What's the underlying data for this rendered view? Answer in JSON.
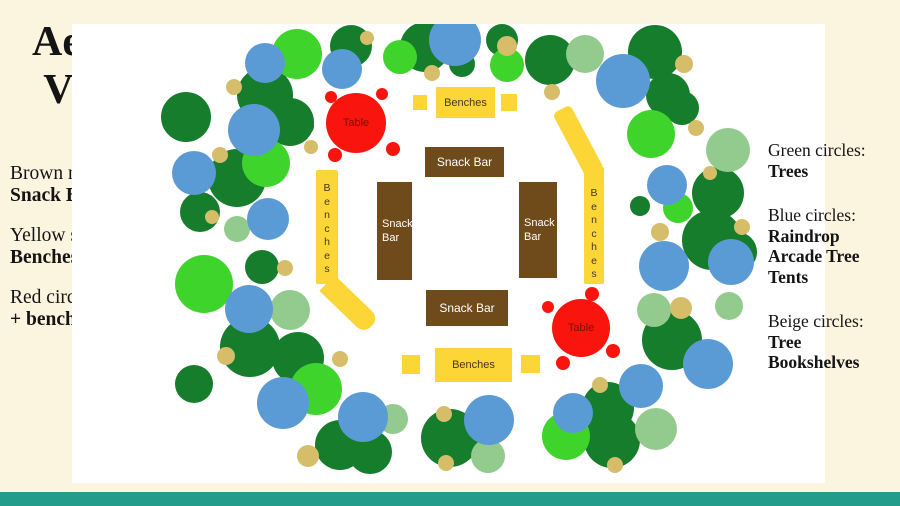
{
  "page": {
    "background": "#FBF4DF",
    "footer_color": "#249C8C"
  },
  "title": {
    "line1": "Aerial",
    "line2": "View"
  },
  "key": {
    "heading": "Key",
    "items": [
      {
        "normal": "Brown rectangles:",
        "bold": "Snack Bars"
      },
      {
        "normal": "Yellow shapes:",
        "bold": "Benches"
      },
      {
        "normal": "Red circle: ",
        "bold": "Tables + benches"
      }
    ]
  },
  "legend_right": {
    "items": [
      {
        "normal": "Green circles:",
        "bold": "Trees"
      },
      {
        "normal": "Blue circles:",
        "bold": "Raindrop Arcade Tree Tents"
      },
      {
        "normal": "Beige circles:",
        "bold": "Tree Bookshelves"
      }
    ]
  },
  "scene": {
    "panel": {
      "x": 72,
      "y": 24,
      "w": 753,
      "h": 459,
      "bg": "#FFFFFF"
    },
    "colors": {
      "dg": "#157D2B",
      "bg": "#3FD42C",
      "sg": "#93CA8E",
      "bl": "#5B9BD5",
      "be": "#D5BD69",
      "yellow": "#FCD637",
      "brown": "#6F4A1A",
      "red": "#F9140E",
      "table_text": "#7C1100",
      "bench_text": "#453916",
      "snack_text": "#FFFFFF"
    },
    "circles": [
      {
        "x": 186,
        "y": 117,
        "r": 25,
        "c": "dg"
      },
      {
        "x": 200,
        "y": 212,
        "r": 20,
        "c": "dg"
      },
      {
        "x": 237,
        "y": 178,
        "r": 29,
        "c": "dg"
      },
      {
        "x": 262,
        "y": 267,
        "r": 17,
        "c": "dg"
      },
      {
        "x": 265,
        "y": 95,
        "r": 28,
        "c": "dg"
      },
      {
        "x": 290,
        "y": 122,
        "r": 24,
        "c": "dg"
      },
      {
        "x": 305,
        "y": 126,
        "r": 9,
        "c": "dg"
      },
      {
        "x": 351,
        "y": 46,
        "r": 21,
        "c": "dg"
      },
      {
        "x": 425,
        "y": 47,
        "r": 25,
        "c": "dg"
      },
      {
        "x": 462,
        "y": 64,
        "r": 13,
        "c": "dg"
      },
      {
        "x": 502,
        "y": 40,
        "r": 16,
        "c": "dg"
      },
      {
        "x": 550,
        "y": 60,
        "r": 25,
        "c": "dg"
      },
      {
        "x": 655,
        "y": 52,
        "r": 27,
        "c": "dg"
      },
      {
        "x": 668,
        "y": 95,
        "r": 22,
        "c": "dg"
      },
      {
        "x": 682,
        "y": 108,
        "r": 17,
        "c": "dg"
      },
      {
        "x": 640,
        "y": 206,
        "r": 10,
        "c": "dg"
      },
      {
        "x": 718,
        "y": 193,
        "r": 26,
        "c": "dg"
      },
      {
        "x": 712,
        "y": 240,
        "r": 30,
        "c": "dg"
      },
      {
        "x": 737,
        "y": 252,
        "r": 20,
        "c": "dg"
      },
      {
        "x": 672,
        "y": 340,
        "r": 30,
        "c": "dg"
      },
      {
        "x": 608,
        "y": 408,
        "r": 26,
        "c": "dg"
      },
      {
        "x": 612,
        "y": 440,
        "r": 28,
        "c": "dg"
      },
      {
        "x": 450,
        "y": 438,
        "r": 29,
        "c": "dg"
      },
      {
        "x": 370,
        "y": 452,
        "r": 22,
        "c": "dg"
      },
      {
        "x": 340,
        "y": 445,
        "r": 25,
        "c": "dg"
      },
      {
        "x": 250,
        "y": 347,
        "r": 30,
        "c": "dg"
      },
      {
        "x": 298,
        "y": 358,
        "r": 26,
        "c": "dg"
      },
      {
        "x": 194,
        "y": 384,
        "r": 19,
        "c": "dg"
      },
      {
        "x": 297,
        "y": 54,
        "r": 25,
        "c": "bg"
      },
      {
        "x": 400,
        "y": 57,
        "r": 17,
        "c": "bg"
      },
      {
        "x": 507,
        "y": 65,
        "r": 17,
        "c": "bg"
      },
      {
        "x": 651,
        "y": 134,
        "r": 24,
        "c": "bg"
      },
      {
        "x": 678,
        "y": 208,
        "r": 15,
        "c": "bg"
      },
      {
        "x": 266,
        "y": 163,
        "r": 24,
        "c": "bg"
      },
      {
        "x": 204,
        "y": 284,
        "r": 29,
        "c": "bg"
      },
      {
        "x": 316,
        "y": 389,
        "r": 26,
        "c": "bg"
      },
      {
        "x": 566,
        "y": 436,
        "r": 24,
        "c": "bg"
      },
      {
        "x": 585,
        "y": 54,
        "r": 19,
        "c": "sg"
      },
      {
        "x": 728,
        "y": 150,
        "r": 22,
        "c": "sg"
      },
      {
        "x": 237,
        "y": 229,
        "r": 13,
        "c": "sg"
      },
      {
        "x": 290,
        "y": 310,
        "r": 20,
        "c": "sg"
      },
      {
        "x": 654,
        "y": 310,
        "r": 17,
        "c": "sg"
      },
      {
        "x": 729,
        "y": 306,
        "r": 14,
        "c": "sg"
      },
      {
        "x": 393,
        "y": 419,
        "r": 15,
        "c": "sg"
      },
      {
        "x": 488,
        "y": 456,
        "r": 17,
        "c": "sg"
      },
      {
        "x": 656,
        "y": 429,
        "r": 21,
        "c": "sg"
      },
      {
        "x": 265,
        "y": 63,
        "r": 20,
        "c": "bl"
      },
      {
        "x": 342,
        "y": 69,
        "r": 20,
        "c": "bl"
      },
      {
        "x": 455,
        "y": 40,
        "r": 26,
        "c": "bl"
      },
      {
        "x": 623,
        "y": 81,
        "r": 27,
        "c": "bl"
      },
      {
        "x": 254,
        "y": 130,
        "r": 26,
        "c": "bl"
      },
      {
        "x": 194,
        "y": 173,
        "r": 22,
        "c": "bl"
      },
      {
        "x": 268,
        "y": 219,
        "r": 21,
        "c": "bl"
      },
      {
        "x": 667,
        "y": 185,
        "r": 20,
        "c": "bl"
      },
      {
        "x": 664,
        "y": 266,
        "r": 25,
        "c": "bl"
      },
      {
        "x": 731,
        "y": 262,
        "r": 23,
        "c": "bl"
      },
      {
        "x": 249,
        "y": 309,
        "r": 24,
        "c": "bl"
      },
      {
        "x": 283,
        "y": 403,
        "r": 26,
        "c": "bl"
      },
      {
        "x": 363,
        "y": 417,
        "r": 25,
        "c": "bl"
      },
      {
        "x": 489,
        "y": 420,
        "r": 25,
        "c": "bl"
      },
      {
        "x": 573,
        "y": 413,
        "r": 20,
        "c": "bl"
      },
      {
        "x": 641,
        "y": 386,
        "r": 22,
        "c": "bl"
      },
      {
        "x": 708,
        "y": 364,
        "r": 25,
        "c": "bl"
      },
      {
        "x": 234,
        "y": 87,
        "r": 8,
        "c": "be"
      },
      {
        "x": 367,
        "y": 38,
        "r": 7,
        "c": "be"
      },
      {
        "x": 432,
        "y": 73,
        "r": 8,
        "c": "be"
      },
      {
        "x": 507,
        "y": 46,
        "r": 10,
        "c": "be"
      },
      {
        "x": 552,
        "y": 92,
        "r": 8,
        "c": "be"
      },
      {
        "x": 684,
        "y": 64,
        "r": 9,
        "c": "be"
      },
      {
        "x": 696,
        "y": 128,
        "r": 8,
        "c": "be"
      },
      {
        "x": 710,
        "y": 173,
        "r": 7,
        "c": "be"
      },
      {
        "x": 660,
        "y": 232,
        "r": 9,
        "c": "be"
      },
      {
        "x": 742,
        "y": 227,
        "r": 8,
        "c": "be"
      },
      {
        "x": 681,
        "y": 308,
        "r": 11,
        "c": "be"
      },
      {
        "x": 285,
        "y": 268,
        "r": 8,
        "c": "be"
      },
      {
        "x": 212,
        "y": 217,
        "r": 7,
        "c": "be"
      },
      {
        "x": 220,
        "y": 155,
        "r": 8,
        "c": "be"
      },
      {
        "x": 311,
        "y": 147,
        "r": 7,
        "c": "be"
      },
      {
        "x": 226,
        "y": 356,
        "r": 9,
        "c": "be"
      },
      {
        "x": 340,
        "y": 359,
        "r": 8,
        "c": "be"
      },
      {
        "x": 308,
        "y": 456,
        "r": 11,
        "c": "be"
      },
      {
        "x": 444,
        "y": 414,
        "r": 8,
        "c": "be"
      },
      {
        "x": 446,
        "y": 463,
        "r": 8,
        "c": "be"
      },
      {
        "x": 600,
        "y": 385,
        "r": 8,
        "c": "be"
      },
      {
        "x": 615,
        "y": 465,
        "r": 8,
        "c": "be"
      }
    ],
    "snack_bars": [
      {
        "label": "Snack Bar",
        "x": 425,
        "y": 147,
        "w": 79,
        "h": 30,
        "wrap": false
      },
      {
        "label": "Snack Bar",
        "x": 377,
        "y": 182,
        "w": 35,
        "h": 98,
        "wrap": true
      },
      {
        "label": "Snack Bar",
        "x": 519,
        "y": 182,
        "w": 38,
        "h": 96,
        "wrap": true
      },
      {
        "label": "Snack Bar",
        "x": 426,
        "y": 290,
        "w": 82,
        "h": 36,
        "wrap": false
      }
    ],
    "bench_rects": [
      {
        "label": "Benches",
        "x": 436,
        "y": 87,
        "w": 59,
        "h": 31
      },
      {
        "label": "Benches",
        "x": 435,
        "y": 348,
        "w": 77,
        "h": 34
      }
    ],
    "bench_squares": [
      {
        "x": 413,
        "y": 95,
        "w": 14,
        "h": 15
      },
      {
        "x": 501,
        "y": 94,
        "w": 16,
        "h": 17
      },
      {
        "x": 402,
        "y": 355,
        "w": 18,
        "h": 19
      },
      {
        "x": 521,
        "y": 355,
        "w": 19,
        "h": 18
      }
    ],
    "bench_paths": [
      {
        "label": "Benches",
        "segments": [
          {
            "x": 316,
            "y": 170,
            "w": 22,
            "h": 114,
            "rot": 0,
            "origin": "50% 0%",
            "radius": "2px",
            "text": true,
            "pt": 12
          },
          {
            "x": 316,
            "y": 283,
            "w": 22,
            "h": 62,
            "rot": -46,
            "origin": "50% 0%",
            "radius": "0 0 10px 10px"
          }
        ]
      },
      {
        "label": "Benches",
        "segments": [
          {
            "x": 584,
            "y": 167,
            "w": 20,
            "h": 117,
            "rot": 0,
            "origin": "50% 0%",
            "radius": "2px",
            "text": true,
            "pt": 20
          },
          {
            "x": 584,
            "y": 101,
            "w": 20,
            "h": 70,
            "rot": -28,
            "origin": "50% 100%",
            "radius": "5px 5px 0 0"
          }
        ]
      }
    ],
    "tables": [
      {
        "label": "Table",
        "x": 356,
        "y": 123,
        "r": 30,
        "seats": [
          {
            "x": 331,
            "y": 97,
            "r": 6
          },
          {
            "x": 382,
            "y": 94,
            "r": 6
          },
          {
            "x": 335,
            "y": 155,
            "r": 7
          },
          {
            "x": 393,
            "y": 149,
            "r": 7
          }
        ]
      },
      {
        "label": "Table",
        "x": 581,
        "y": 328,
        "r": 29,
        "seats": [
          {
            "x": 548,
            "y": 307,
            "r": 6
          },
          {
            "x": 592,
            "y": 294,
            "r": 7
          },
          {
            "x": 563,
            "y": 363,
            "r": 7
          },
          {
            "x": 613,
            "y": 351,
            "r": 7
          }
        ]
      }
    ]
  }
}
